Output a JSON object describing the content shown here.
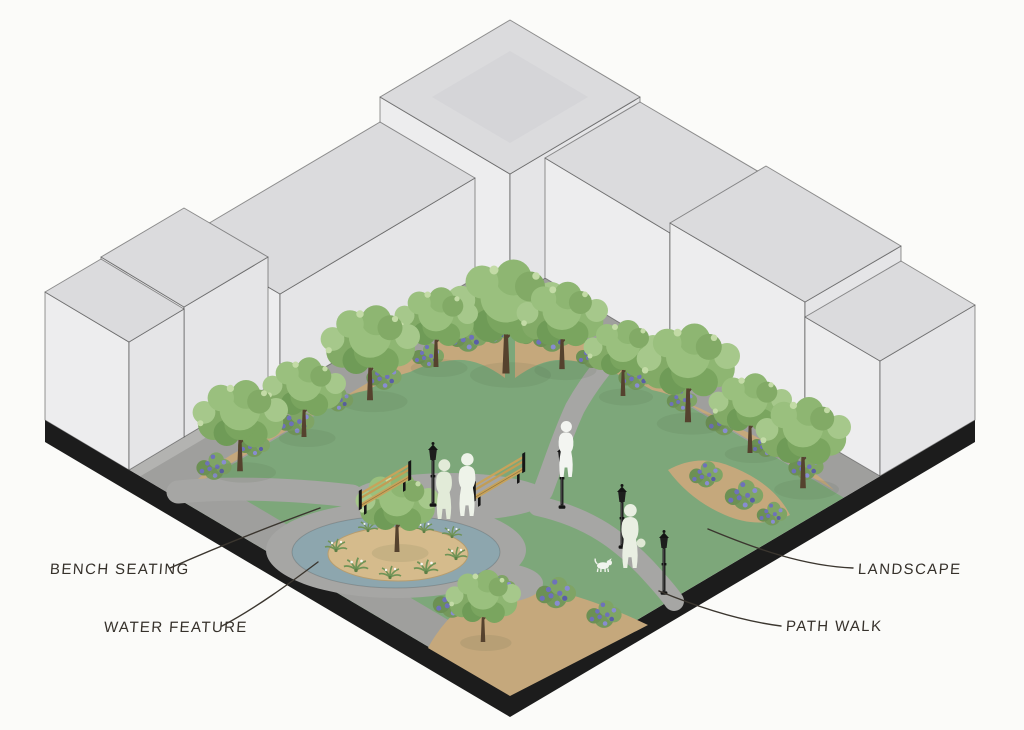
{
  "figure": {
    "type": "axonometric-site-diagram",
    "subject": "Pocket park concept surrounded by building massing",
    "canvas": {
      "width": 1024,
      "height": 730
    }
  },
  "callouts": [
    {
      "id": "bench-seating",
      "label": "BENCH SEATING"
    },
    {
      "id": "water-feature",
      "label": "WATER FEATURE"
    },
    {
      "id": "landscape",
      "label": "LANDSCAPE"
    },
    {
      "id": "path-walk",
      "label": "PATH WALK"
    }
  ],
  "colors": {
    "background": "#fbfbf9",
    "plinth": "#1c1c1c",
    "ground": "#b3b3b1",
    "lawn": "#7da77a",
    "sidewalk": "#9f9f9d",
    "path": "#a6a6a4",
    "bed": "#c5a87c",
    "sand": "#d5bb8c",
    "water": "#8da6ae",
    "building_left_face": "#ededee",
    "building_right_face": "#e5e5e7",
    "building_top_face": "#dbdbdd",
    "outline": "#2f2f2f",
    "foliage_green": "#8eb672",
    "flower_purple": "#6e71ba",
    "bench_wood": "#c7a35b",
    "lamp_black": "#242424",
    "figure_white": "#eef3e9",
    "leader": "#3b362f",
    "label_text": "#36312b"
  }
}
